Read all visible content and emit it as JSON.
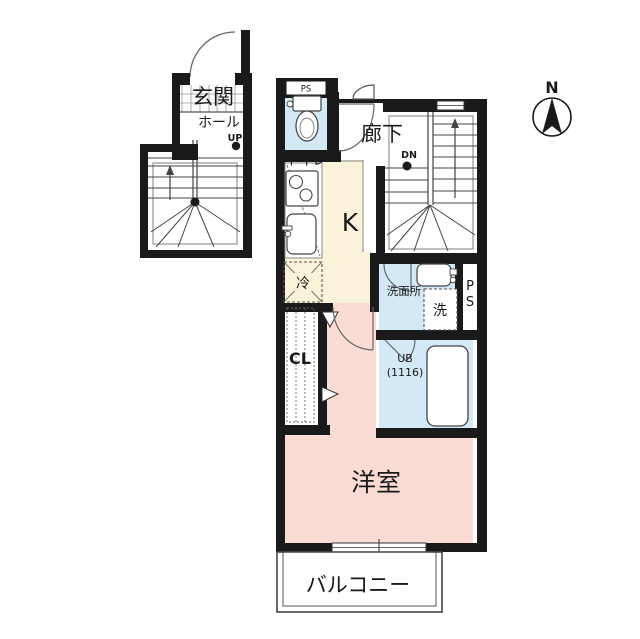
{
  "labels": {
    "entrance": "玄関",
    "hall": "ホール",
    "up": "UP",
    "ps_stair": "PS",
    "toilet": "トイレ",
    "ps_toilet": "PS",
    "corridor": "廊下",
    "down": "DN",
    "kitchen": "K",
    "refrigerator": "冷",
    "washroom": "洗面所",
    "washer": "洗",
    "pipe_space_p": "P",
    "pipe_space_s": "S",
    "unit_bath": "UB",
    "unit_bath_size": "(1116)",
    "closet": "CL",
    "western_room": "洋室",
    "balcony": "バルコニー",
    "compass_north": "N"
  },
  "colors": {
    "wall": "#1a1a1a",
    "room_pink": "#fadcd5",
    "kitchen_cream": "#faf3da",
    "wet_blue": "#d3eaf6",
    "line_gray": "#777777"
  }
}
